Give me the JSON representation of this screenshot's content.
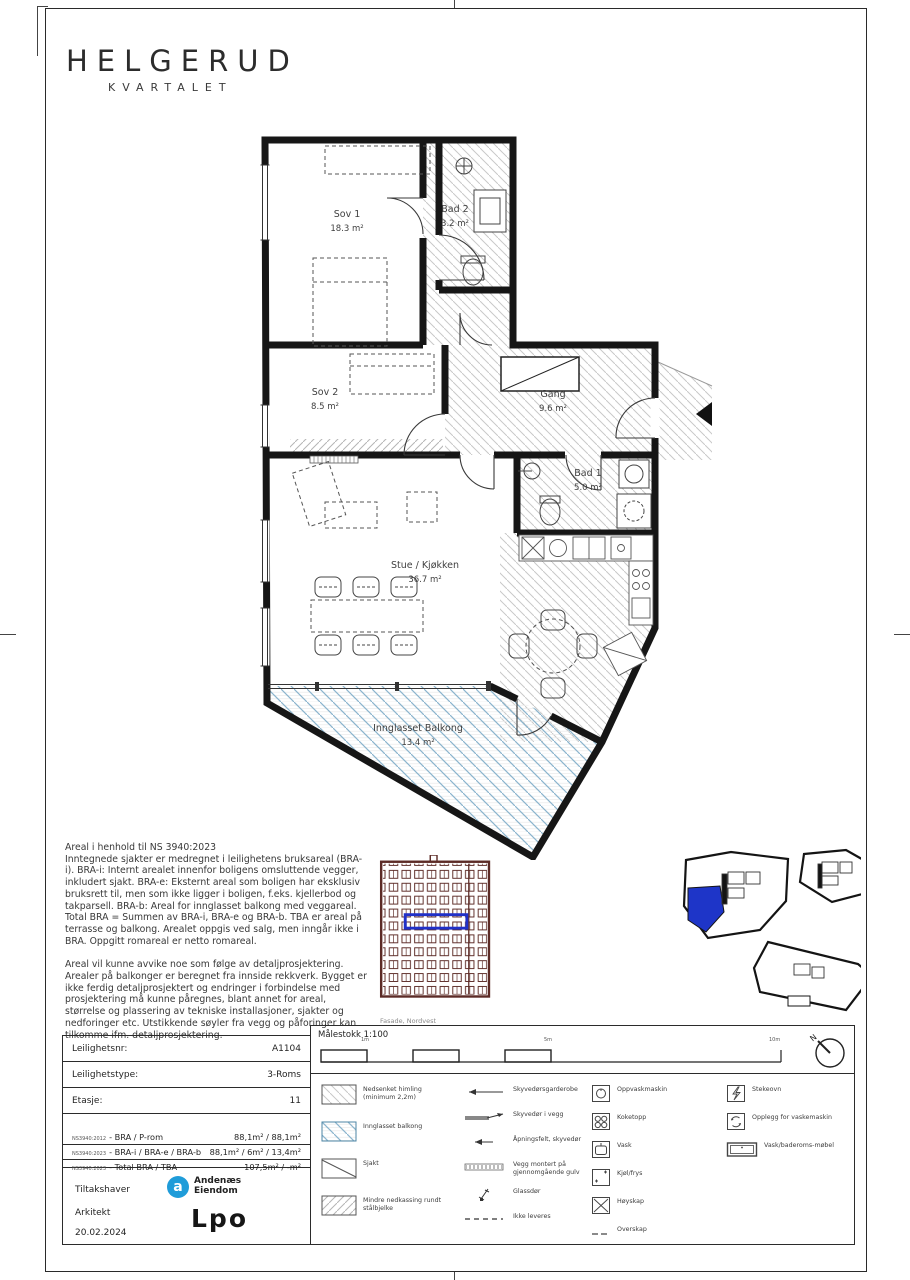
{
  "brand": {
    "name": "HELGERUD",
    "sub": "KVARTALET"
  },
  "plan": {
    "rooms": [
      {
        "name": "Sov 1",
        "area": "18.3 m²"
      },
      {
        "name": "Bad 2",
        "area": "3.2 m²"
      },
      {
        "name": "Sov 2",
        "area": "8.5 m²"
      },
      {
        "name": "Gang",
        "area": "9.6 m²"
      },
      {
        "name": "Bad 1",
        "area": "5.0 m²"
      },
      {
        "name": "Stue / Kjøkken",
        "area": "36.7 m²"
      },
      {
        "name": "Innglasset Balkong",
        "area": "13.4 m²"
      }
    ]
  },
  "notes": {
    "title": "Areal i henhold til NS 3940:2023",
    "p1": "Inntegnede sjakter er medregnet i leilighetens bruksareal (BRA-i). BRA-i: Internt arealet innenfor boligens omsluttende vegger, inkludert sjakt. BRA-e: Eksternt areal som boligen har eksklusiv bruksrett til, men som ikke ligger i boligen, f.eks. kjellerbod og takparsell. BRA-b: Areal for innglasset balkong med veggareal. Total BRA = Summen av BRA-i, BRA-e og BRA-b. TBA er areal på terrasse og balkong. Arealet oppgis ved salg, men inngår ikke i BRA. Oppgitt romareal er netto romareal.",
    "p2": "Areal vil kunne avvike noe som følge av detaljprosjektering. Arealer på balkonger er beregnet fra innside rekkverk. Bygget er ikke ferdig detaljprosjektert og endringer i forbindelse med prosjektering må kunne påregnes, blant annet for areal, størrelse og plassering av tekniske installasjoner, sjakter og nedforinger etc. Utstikkende søyler fra vegg og påforinger kan tilkomme ifm. detaljprosjektering."
  },
  "facade": {
    "caption": "Fasade, Nordvest"
  },
  "info": {
    "rows": [
      {
        "label": "Leilighetsnr:",
        "value": "A1104"
      },
      {
        "label": "Leilighetstype:",
        "value": "3-Roms"
      },
      {
        "label": "Etasje:",
        "value": "11"
      }
    ],
    "areas": [
      {
        "std": "NS3940:2012",
        "label": "- BRA / P-rom",
        "value": "88,1m² / 88,1m²"
      },
      {
        "std": "NS3940:2023",
        "label": "- BRA-i / BRA-e / BRA-b",
        "value": "88,1m² / 6m² / 13,4m²"
      },
      {
        "std": "NS3940:2023",
        "label": "- Total BRA / TBA",
        "value": "107,5m² / -m²"
      }
    ]
  },
  "footer": {
    "role1": "Tiltakshaver",
    "role2": "Arkitekt",
    "date": "20.02.2024",
    "logo1_mark": "a",
    "logo1_line1": "Andenæs",
    "logo1_line2": "Eiendom",
    "logo2": "Lpo"
  },
  "legend": {
    "scale_title": "Målestokk 1:100",
    "ticks": [
      "1m",
      "5m",
      "10m"
    ],
    "north": "N",
    "col1": [
      {
        "label": "Nedsenket himling (minimum 2,2m)"
      },
      {
        "label": "Innglasset balkong"
      },
      {
        "label": "Sjakt"
      },
      {
        "label": "Mindre nedkassing rundt stålbjelke"
      }
    ],
    "col2": [
      {
        "label": "Skyvedørsgarderobe"
      },
      {
        "label": "Skyvedør i vegg"
      },
      {
        "label": "Åpningsfelt, skyvedør"
      },
      {
        "label": "Vegg montert på gjennomgående gulv"
      },
      {
        "label": "Glassdør"
      },
      {
        "label": "Ikke leveres"
      }
    ],
    "col3": [
      {
        "label": "Oppvaskmaskin"
      },
      {
        "label": "Koketopp"
      },
      {
        "label": "Vask"
      },
      {
        "label": "Kjøl/frys"
      },
      {
        "label": "Høyskap"
      },
      {
        "label": "Overskap"
      }
    ],
    "col4": [
      {
        "label": "Stekeovn"
      },
      {
        "label": "Opplegg for vaskemaskin"
      },
      {
        "label": "Vask/baderoms-møbel"
      }
    ]
  },
  "colors": {
    "accent_blue": "#1e35c8",
    "balcony_hatch_blue": "#8ab4cd",
    "facade_line": "#5c2b26",
    "logo_blue": "#1f9cd9",
    "wall_black": "#161616"
  }
}
